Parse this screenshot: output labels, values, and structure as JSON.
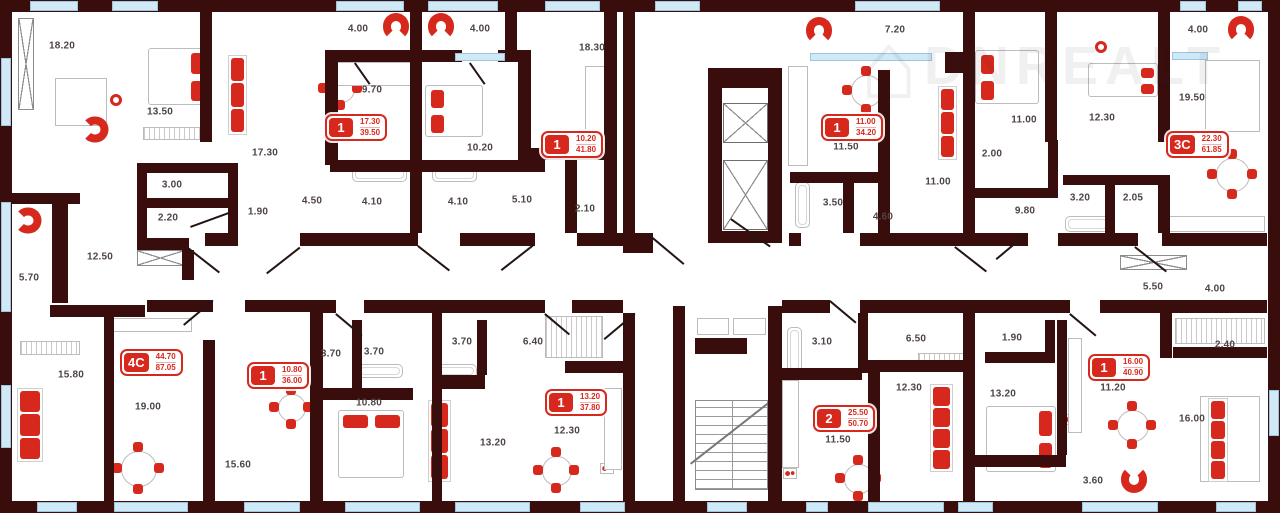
{
  "plan_title": "Residential floor plan",
  "watermark": {
    "text": "DNREALT",
    "icon": "house-icon"
  },
  "accent_colors": {
    "wall": "#3a0d0d",
    "accent_red": "#d7281d",
    "window_blue": "#cfe9f7"
  },
  "apartments": [
    {
      "type": "1",
      "area_living": "17.30",
      "area_total": "39.50",
      "x": 325,
      "y": 114
    },
    {
      "type": "1",
      "area_living": "10.20",
      "area_total": "41.80",
      "x": 541,
      "y": 131
    },
    {
      "type": "1",
      "area_living": "11.00",
      "area_total": "34.20",
      "x": 821,
      "y": 114
    },
    {
      "type": "3C",
      "area_living": "22.30",
      "area_total": "61.85",
      "x": 1166,
      "y": 131
    },
    {
      "type": "4C",
      "area_living": "44.70",
      "area_total": "87.05",
      "x": 120,
      "y": 349
    },
    {
      "type": "1",
      "area_living": "10.80",
      "area_total": "36.00",
      "x": 247,
      "y": 362
    },
    {
      "type": "1",
      "area_living": "13.20",
      "area_total": "37.80",
      "x": 545,
      "y": 389
    },
    {
      "type": "2",
      "area_living": "25.50",
      "area_total": "50.70",
      "x": 813,
      "y": 405
    },
    {
      "type": "1",
      "area_living": "16.00",
      "area_total": "40.90",
      "x": 1088,
      "y": 354
    }
  ],
  "room_labels": [
    {
      "text": "18.20",
      "x": 62,
      "y": 46
    },
    {
      "text": "13.50",
      "x": 160,
      "y": 112
    },
    {
      "text": "17.30",
      "x": 265,
      "y": 153
    },
    {
      "text": "3.00",
      "x": 172,
      "y": 185
    },
    {
      "text": "2.20",
      "x": 168,
      "y": 218
    },
    {
      "text": "1.90",
      "x": 258,
      "y": 212
    },
    {
      "text": "12.50",
      "x": 100,
      "y": 257
    },
    {
      "text": "5.70",
      "x": 29,
      "y": 278
    },
    {
      "text": "4.00",
      "x": 358,
      "y": 29
    },
    {
      "text": "4.00",
      "x": 480,
      "y": 29
    },
    {
      "text": "9.70",
      "x": 372,
      "y": 90
    },
    {
      "text": "10.20",
      "x": 480,
      "y": 148
    },
    {
      "text": "18.30",
      "x": 592,
      "y": 48
    },
    {
      "text": "4.50",
      "x": 312,
      "y": 201
    },
    {
      "text": "4.10",
      "x": 372,
      "y": 202
    },
    {
      "text": "4.10",
      "x": 458,
      "y": 202
    },
    {
      "text": "5.10",
      "x": 522,
      "y": 200
    },
    {
      "text": "2.10",
      "x": 585,
      "y": 209
    },
    {
      "text": "7.20",
      "x": 895,
      "y": 30
    },
    {
      "text": "11.50",
      "x": 846,
      "y": 147
    },
    {
      "text": "11.00",
      "x": 938,
      "y": 182
    },
    {
      "text": "3.50",
      "x": 833,
      "y": 203
    },
    {
      "text": "4.60",
      "x": 883,
      "y": 217
    },
    {
      "text": "4.00",
      "x": 1198,
      "y": 30
    },
    {
      "text": "11.00",
      "x": 1024,
      "y": 120
    },
    {
      "text": "12.30",
      "x": 1102,
      "y": 118
    },
    {
      "text": "19.50",
      "x": 1192,
      "y": 98
    },
    {
      "text": "2.00",
      "x": 992,
      "y": 154
    },
    {
      "text": "9.80",
      "x": 1025,
      "y": 211
    },
    {
      "text": "3.20",
      "x": 1080,
      "y": 198
    },
    {
      "text": "2.05",
      "x": 1133,
      "y": 198
    },
    {
      "text": "5.50",
      "x": 1153,
      "y": 287
    },
    {
      "text": "4.00",
      "x": 1215,
      "y": 289
    },
    {
      "text": "15.80",
      "x": 71,
      "y": 375
    },
    {
      "text": "19.00",
      "x": 148,
      "y": 407
    },
    {
      "text": "15.60",
      "x": 238,
      "y": 465
    },
    {
      "text": "3.70",
      "x": 331,
      "y": 354
    },
    {
      "text": "3.70",
      "x": 374,
      "y": 352
    },
    {
      "text": "3.70",
      "x": 462,
      "y": 342
    },
    {
      "text": "6.40",
      "x": 533,
      "y": 342
    },
    {
      "text": "10.80",
      "x": 369,
      "y": 403
    },
    {
      "text": "13.20",
      "x": 493,
      "y": 443
    },
    {
      "text": "12.30",
      "x": 567,
      "y": 431
    },
    {
      "text": "3.10",
      "x": 822,
      "y": 342
    },
    {
      "text": "6.50",
      "x": 916,
      "y": 339
    },
    {
      "text": "12.30",
      "x": 909,
      "y": 388
    },
    {
      "text": "11.50",
      "x": 838,
      "y": 440
    },
    {
      "text": "1.90",
      "x": 1012,
      "y": 338
    },
    {
      "text": "2.40",
      "x": 1225,
      "y": 345
    },
    {
      "text": "13.20",
      "x": 1003,
      "y": 394
    },
    {
      "text": "11.20",
      "x": 1113,
      "y": 388
    },
    {
      "text": "16.00",
      "x": 1192,
      "y": 419
    },
    {
      "text": "3.60",
      "x": 1093,
      "y": 481
    }
  ]
}
